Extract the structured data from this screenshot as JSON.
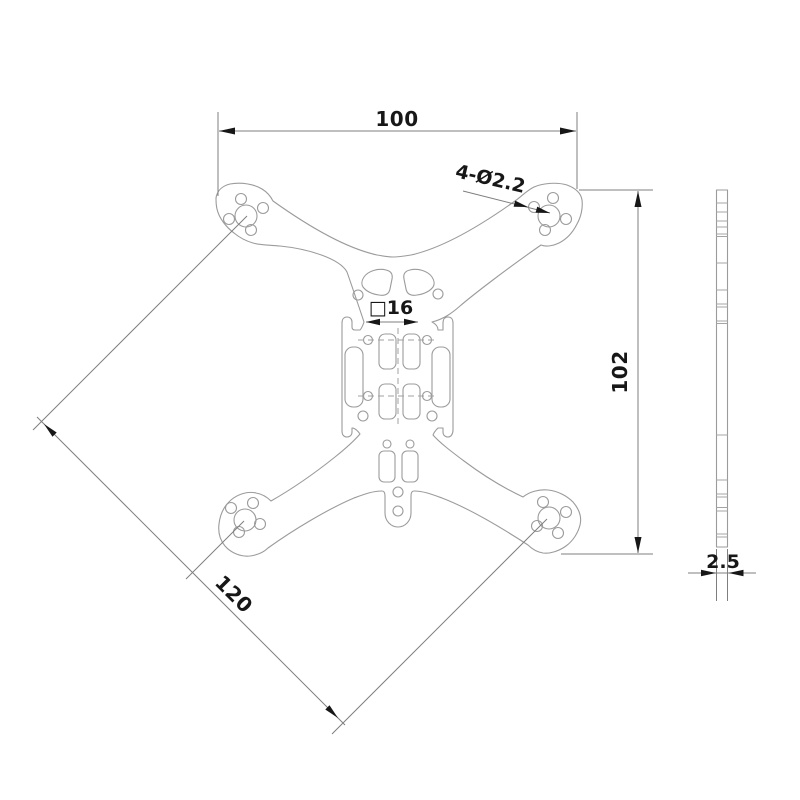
{
  "drawing": {
    "dim_width_label": "100",
    "dim_height_label": "102",
    "dim_diagonal_label": "120",
    "hole_callout_label": "4-Ø2.2",
    "square_dim_label": "□16",
    "thickness_label": "2.5"
  },
  "colors": {
    "background": "#ffffff",
    "geometry_line": "#9b9b9b",
    "dimension_line": "#7f7f7f",
    "annotation": "#171717"
  }
}
